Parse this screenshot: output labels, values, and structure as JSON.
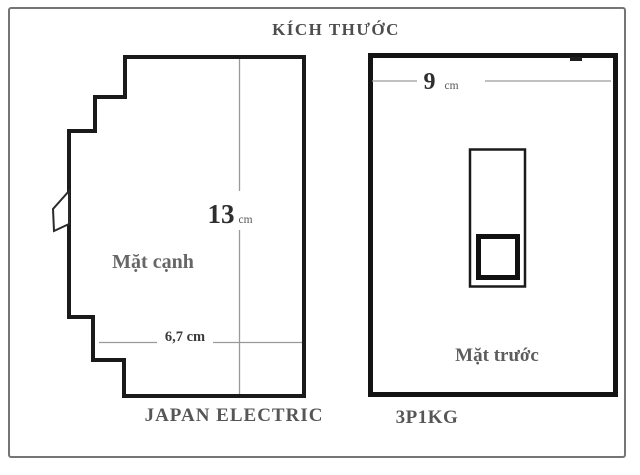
{
  "title": "KÍCH THƯỚC",
  "side_view": {
    "label": "Mặt cạnh",
    "brand": "JAPAN ELECTRIC",
    "height_value": "13",
    "height_unit": "cm",
    "depth_dim": "6,7 cm"
  },
  "front_view": {
    "label": "Mặt trước",
    "model": "3P1KG",
    "width_value": "9",
    "width_unit": "cm"
  },
  "colors": {
    "outline": "#1a1a1a",
    "dimension_line": "#9a9a9a",
    "label_gray": "#5d5d5d",
    "frame_border": "#757575",
    "background": "#ffffff"
  }
}
